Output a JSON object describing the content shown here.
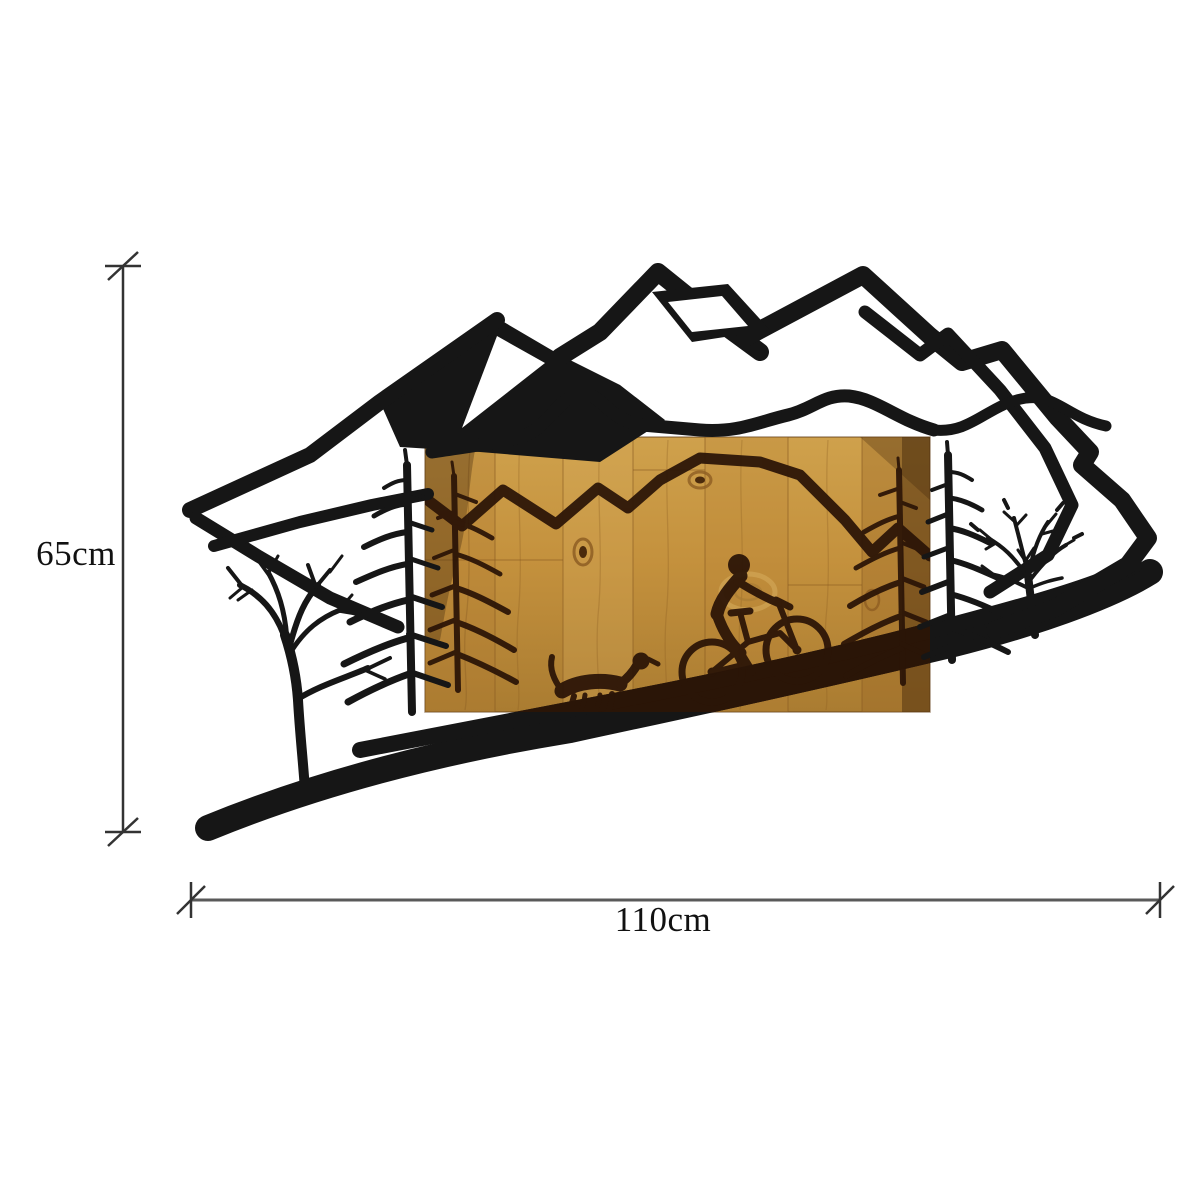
{
  "page": {
    "background_color": "#ffffff",
    "content_type": "product dimension illustration"
  },
  "dimensions": {
    "height": {
      "label": "65cm",
      "orientation": "vertical"
    },
    "width": {
      "label": "110cm",
      "orientation": "horizontal"
    }
  },
  "artwork": {
    "kind": "metal-and-wood wall art",
    "scene_elements": [
      "mountain-range-silhouette",
      "wood-panel",
      "etched-trail-line",
      "mountain-biker",
      "running-dog",
      "etched-pine-tree-left",
      "etched-pine-tree-right",
      "metal-pine-tree-left",
      "metal-pine-tree-right",
      "bare-tree-left",
      "branch-tree-right",
      "sloping-ground"
    ]
  },
  "colors": {
    "metal_silhouette": "#161616",
    "wood_light": "#d4a352",
    "wood_base": "#c4913d",
    "wood_shadow": "#a4762e",
    "wood_etch": "#2c1507",
    "dimension_line_vertical": "#333333",
    "dimension_line_horizontal": "#595959",
    "label_text": "#111111"
  }
}
